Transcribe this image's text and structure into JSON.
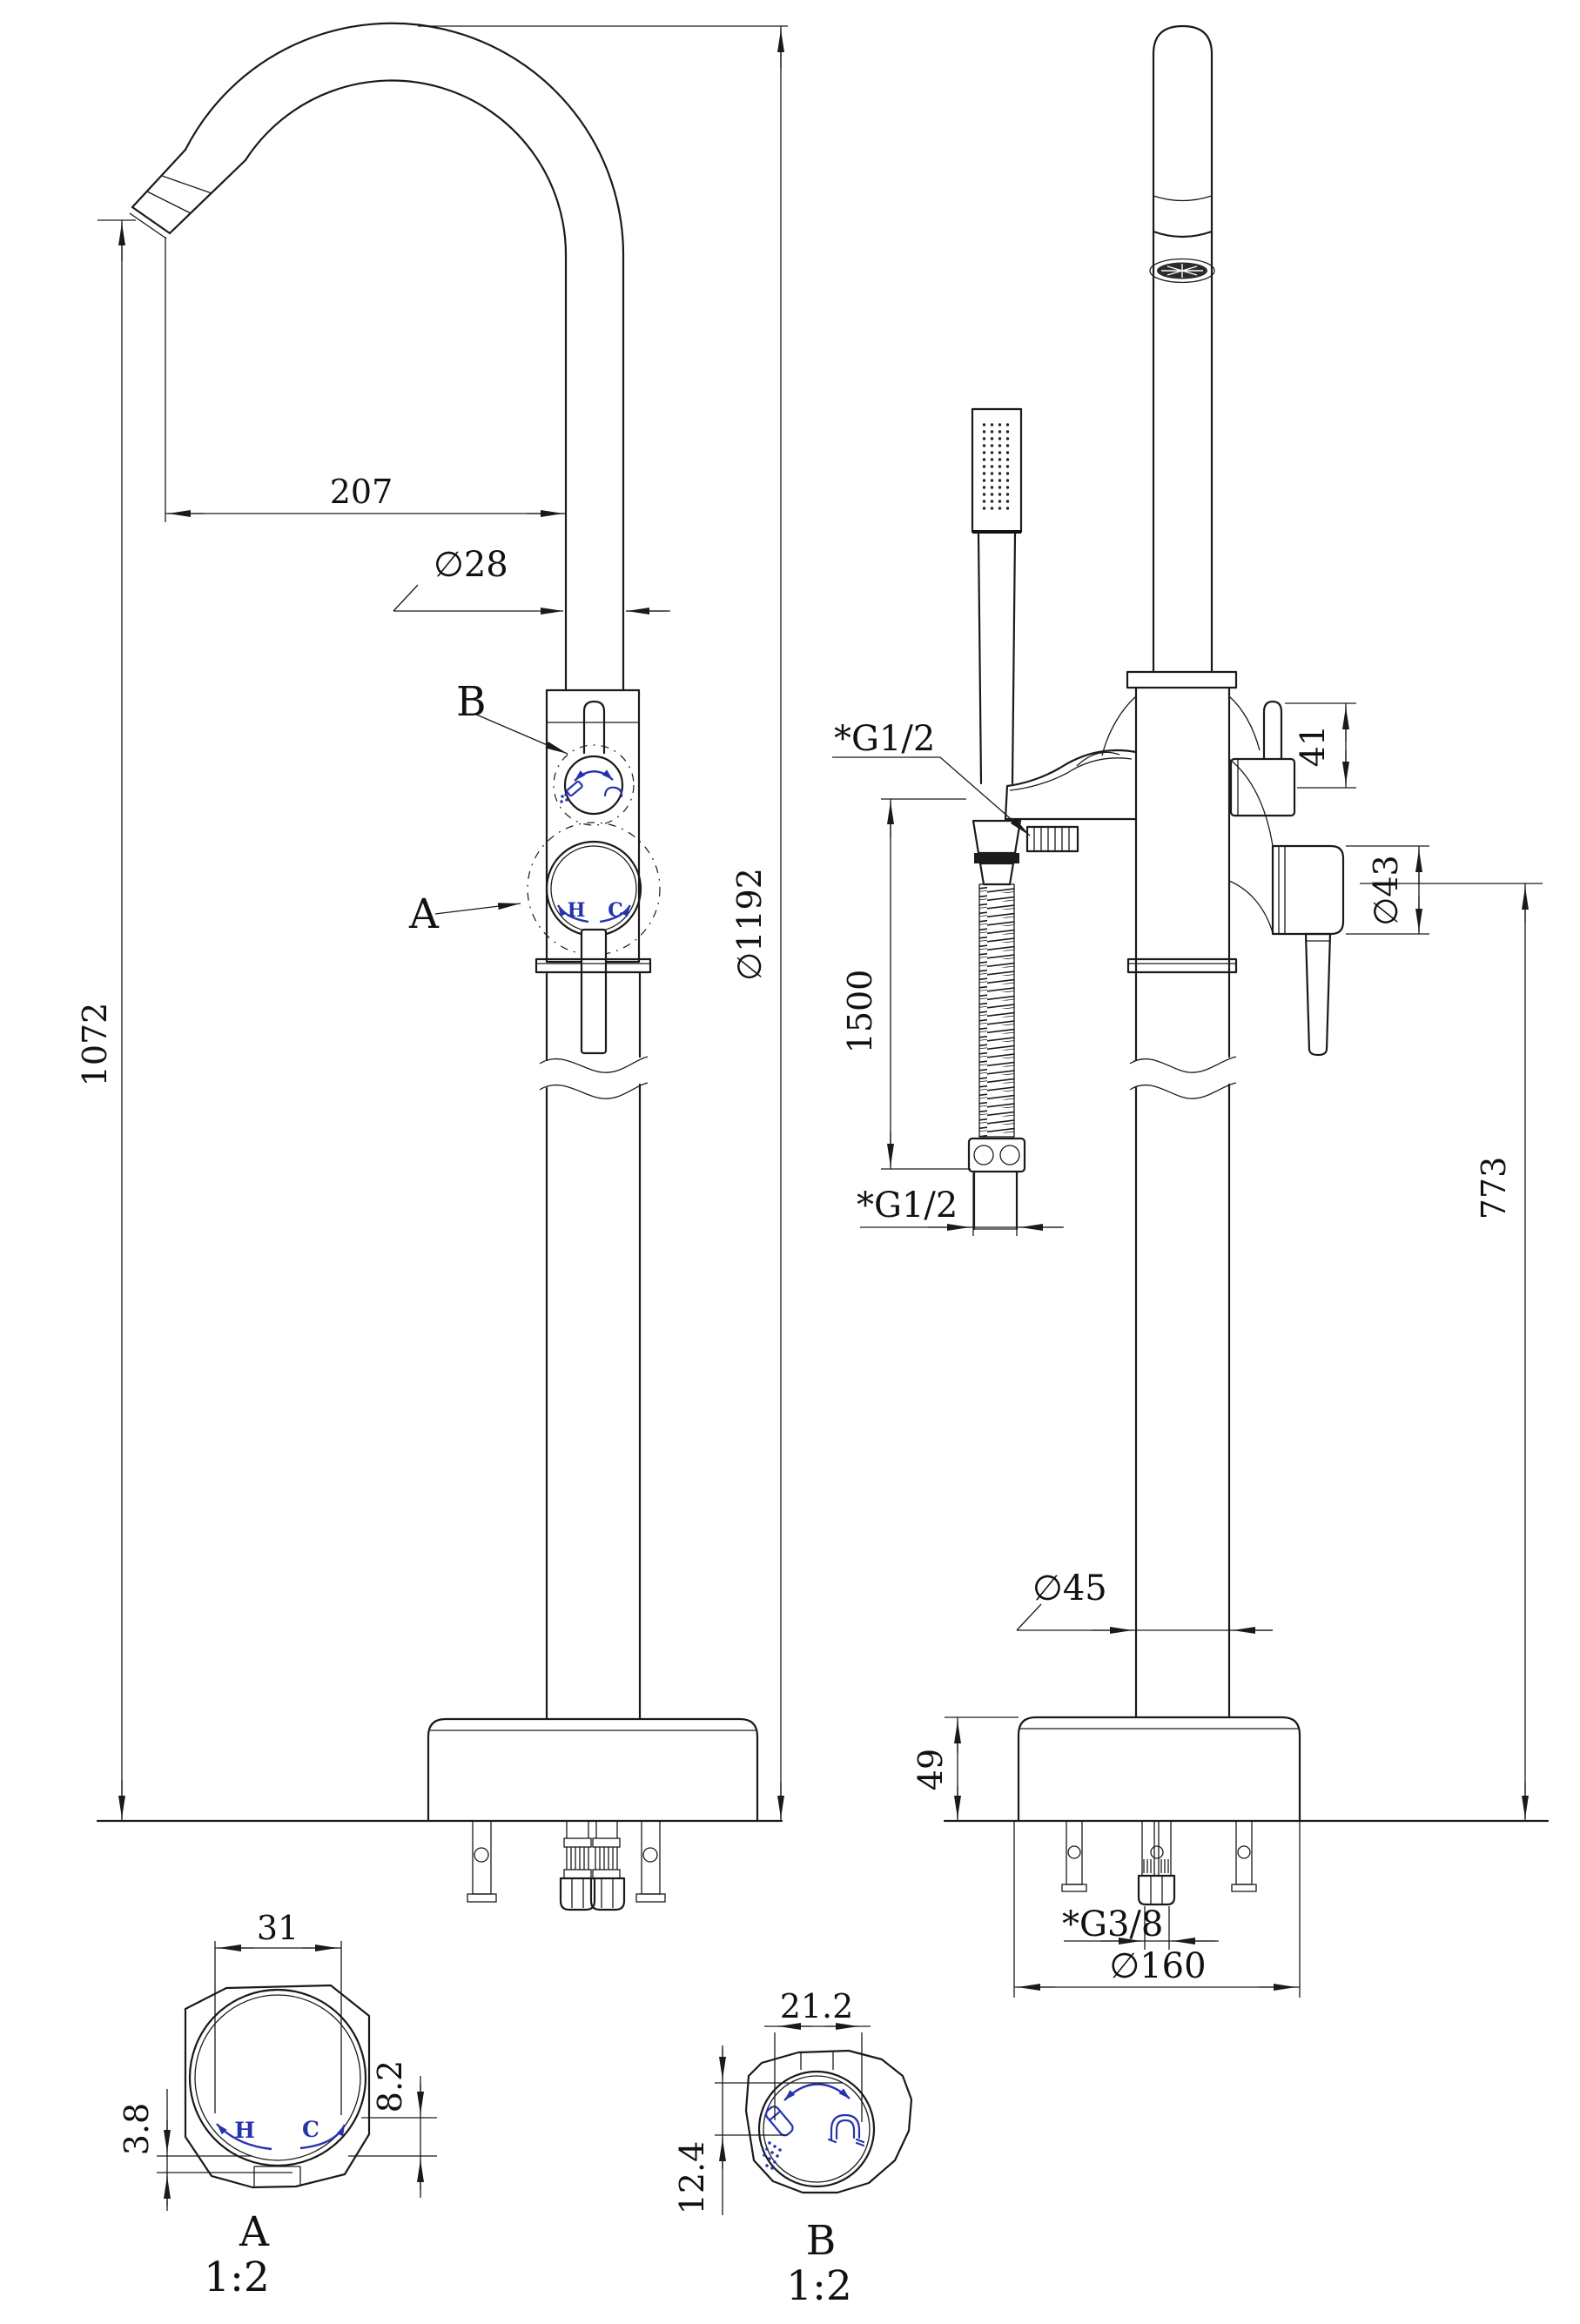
{
  "colors": {
    "line": "#1a1a1a",
    "accent_blue": "#2633ae"
  },
  "front_view": {
    "dim_spout_reach": "207",
    "dim_spout_diameter": "∅28",
    "dim_spout_height": "1072",
    "dim_overall_height": "∅1192",
    "callout_b": "B",
    "callout_a": "A",
    "handle_hot": "H",
    "handle_cold": "C"
  },
  "side_view": {
    "thread_shower_outlet": "*G1/2",
    "dim_hose_length": "1500",
    "thread_hose_end": "*G1/2",
    "dim_diverter_stem": "41",
    "dim_handle_diameter": "∅43",
    "dim_handle_height": "773",
    "dim_riser_diameter": "∅45",
    "dim_base_height": "49",
    "thread_inlet": "*G3/8",
    "dim_base_diameter": "∅160"
  },
  "detail_a": {
    "dim_width": "31",
    "dim_lip": "3.8",
    "dim_flat": "8.2",
    "hot": "H",
    "cold": "C",
    "label": "A",
    "scale": "1:2"
  },
  "detail_b": {
    "dim_width": "21.2",
    "dim_height": "12.4",
    "label": "B",
    "scale": "1:2"
  }
}
